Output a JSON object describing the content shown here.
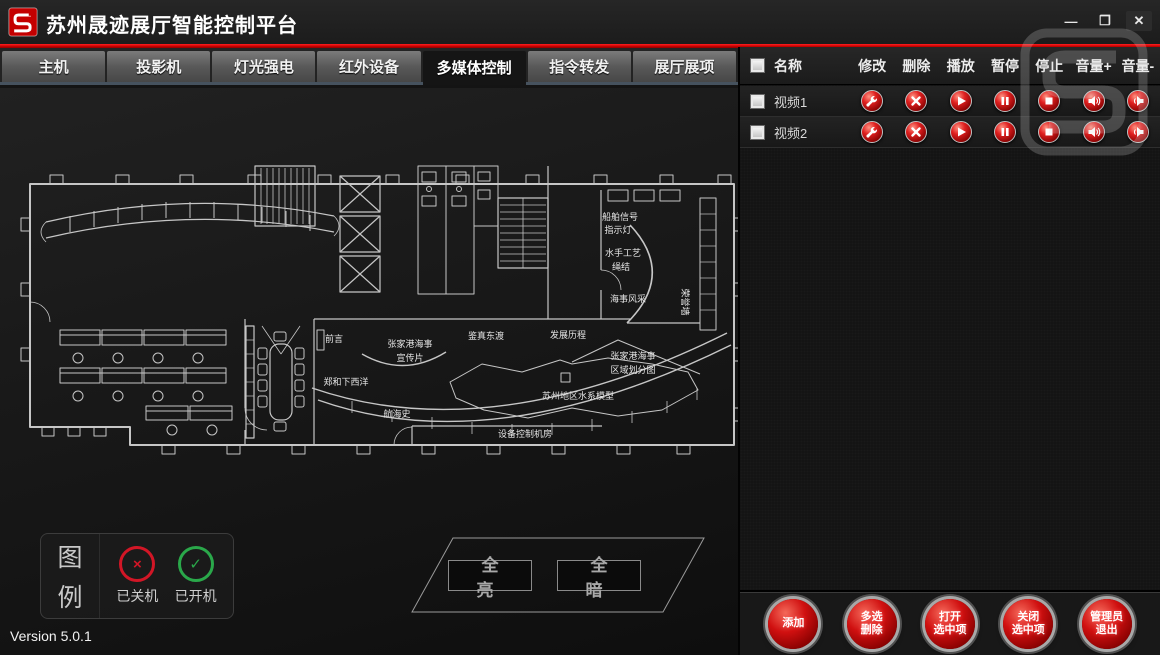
{
  "window": {
    "title": "苏州晟迹展厅智能控制平台",
    "version": "Version 5.0.1"
  },
  "tabs": {
    "items": [
      {
        "label": "主机",
        "active": false
      },
      {
        "label": "投影机",
        "active": false
      },
      {
        "label": "灯光强电",
        "active": false
      },
      {
        "label": "红外设备",
        "active": false
      },
      {
        "label": "多媒体控制",
        "active": true
      },
      {
        "label": "指令转发",
        "active": false
      },
      {
        "label": "展厅展项",
        "active": false
      }
    ]
  },
  "floorplan": {
    "labels": {
      "qianyan": "前言",
      "xuanchuan_1": "张家港海事",
      "xuanchuan_2": "宣传片",
      "jianzhen": "鉴真东渡",
      "fazhan": "发展历程",
      "zhenghe": "郑和下西洋",
      "hanghaishi": "航海史",
      "shebei": "设备控制机房",
      "chuanbo_1": "船舶信号",
      "chuanbo_2": "指示灯",
      "shuishou_1": "水手工艺",
      "shuishou_2": "绳结",
      "haishi_fengcai": "海事风采",
      "quyu_1": "张家港海事",
      "quyu_2": "区域划分图",
      "shuixi": "苏州地区水系模型",
      "rongyu": "荣誉墙"
    }
  },
  "legend": {
    "char_top": "图",
    "char_bottom": "例",
    "off_symbol": "×",
    "on_symbol": "✓",
    "off_label": "已关机",
    "on_label": "已开机"
  },
  "light_controls": {
    "all_bright": "全 亮",
    "all_dark": "全 暗"
  },
  "media_panel": {
    "headers": [
      "名称",
      "修改",
      "删除",
      "播放",
      "暂停",
      "停止",
      "音量+",
      "音量-"
    ],
    "rows": [
      {
        "name": "视频1"
      },
      {
        "name": "视频2"
      }
    ]
  },
  "actions": [
    {
      "line1": "添加",
      "line2": ""
    },
    {
      "line1": "多选",
      "line2": "删除"
    },
    {
      "line1": "打开",
      "line2": "选中项"
    },
    {
      "line1": "关闭",
      "line2": "选中项"
    },
    {
      "line1": "管理员",
      "line2": "退出"
    }
  ],
  "colors": {
    "accent_red": "#d40000",
    "button_red": "#c01010",
    "tab_gray": "#5f5f5f",
    "panel_bg": "#151515",
    "plan_line": "#c9c9c9",
    "legend_off": "#d21626",
    "legend_on": "#2aa84a"
  }
}
